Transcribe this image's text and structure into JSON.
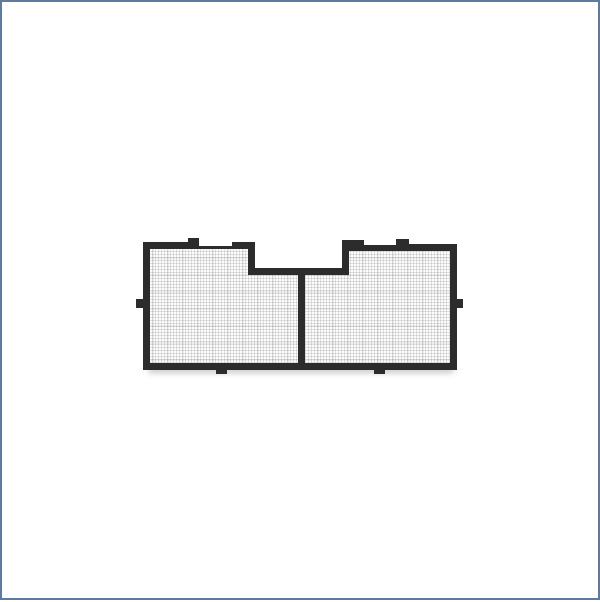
{
  "image": {
    "type": "product-render",
    "object_label": "Black-framed rectangular mesh screen with two fine-mesh panels separated by a center divider, a notched top-center section, stepped top edges, and six small mounting tabs (top-left, top-right, left, right, and two on the bottom), shown on a plain white background",
    "background_label": "plain white page with thin blue-gray border"
  },
  "colors": {
    "page-bg": "#ffffff",
    "page-border": "#60799e",
    "frame": "#2c2c2c",
    "mesh-bg": "#fcfcfc",
    "mesh-line": "rgba(0,0,0,0.11)",
    "mesh-accent": "rgba(0,0,0,0.05)",
    "shadow": "rgba(0,0,0,0.22)"
  }
}
